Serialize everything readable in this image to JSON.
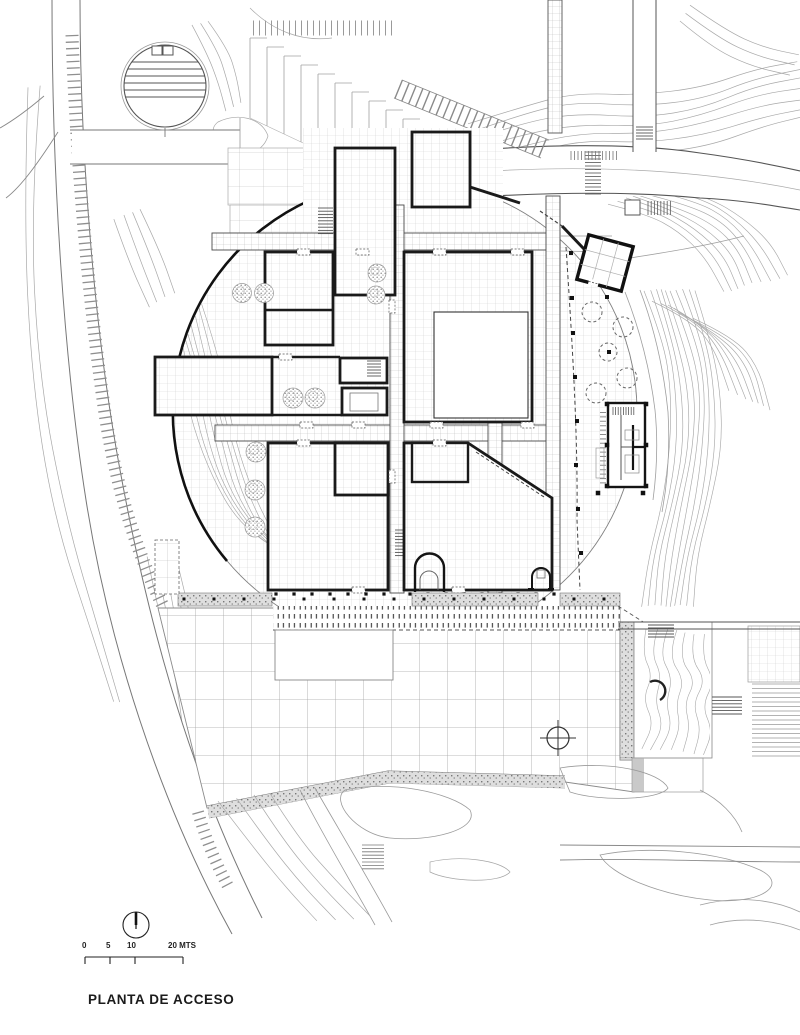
{
  "sheet": {
    "title": "PLANTA DE ACCESO",
    "scale_bar": {
      "labels": [
        "0",
        "5",
        "10",
        "20 MTS"
      ]
    },
    "colors": {
      "paper": "#ffffff",
      "ink": "#161616",
      "wall": "#1a1a1a",
      "medium": "#5a5a5a",
      "light": "#9b9b9b",
      "contour": "#a8a8a8",
      "grid_fine": "#cfcfcf",
      "grid_dense": "#bdbdbd",
      "grid_coarse": "#a3a3a3",
      "gravel": "#8a8a8a"
    }
  }
}
